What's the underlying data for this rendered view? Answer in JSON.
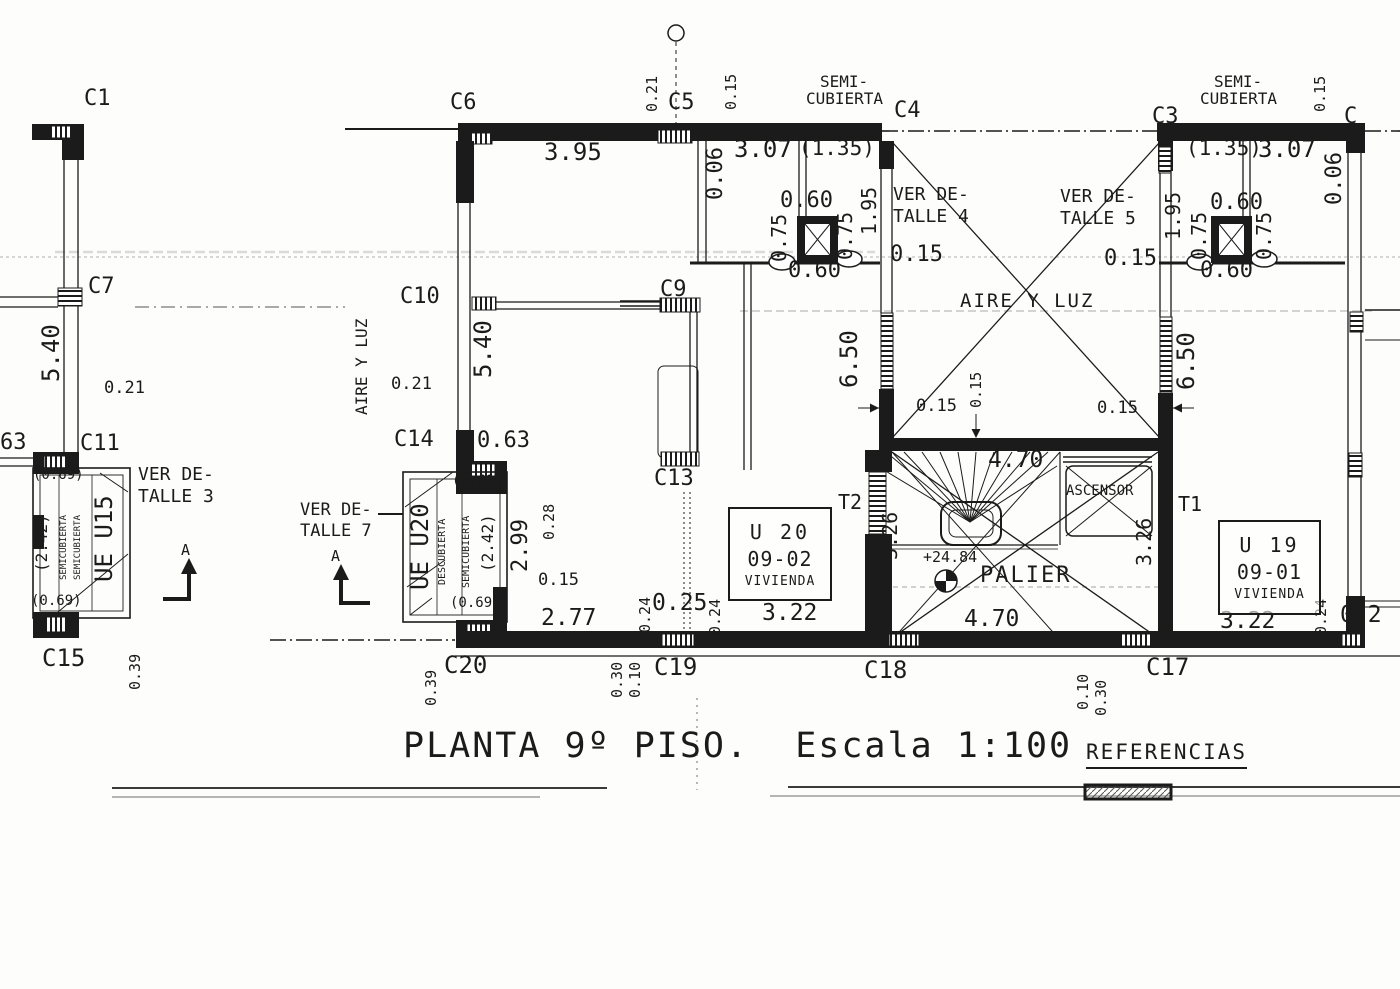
{
  "document": {
    "title": "PLANTA 9º PISO.  Escala 1:100",
    "references_heading": "REFERENCIAS"
  },
  "plan": {
    "floor": "9º PISO",
    "scale": "1:100",
    "level_mark": "+24.84",
    "units": {
      "u20": {
        "line1": "U 20",
        "line2": "09-02",
        "line3": "VIVIENDA"
      },
      "u19": {
        "line1": "U 19",
        "line2": "09-01",
        "line3": "VIVIENDA"
      }
    },
    "labels": [
      {
        "t": "C1",
        "x": 84,
        "y": 88,
        "s": 22,
        "k": "column-label"
      },
      {
        "t": "C6",
        "x": 450,
        "y": 92,
        "s": 22,
        "k": "column-label"
      },
      {
        "t": "C5",
        "x": 668,
        "y": 92,
        "s": 22,
        "k": "column-label"
      },
      {
        "t": "C4",
        "x": 894,
        "y": 100,
        "s": 22,
        "k": "column-label"
      },
      {
        "t": "C3",
        "x": 1152,
        "y": 106,
        "s": 22,
        "k": "column-label"
      },
      {
        "t": "C",
        "x": 1344,
        "y": 106,
        "s": 22,
        "k": "column-label"
      },
      {
        "t": "C7",
        "x": 88,
        "y": 276,
        "s": 22,
        "k": "column-label"
      },
      {
        "t": "C10",
        "x": 400,
        "y": 286,
        "s": 22,
        "k": "column-label"
      },
      {
        "t": "C9",
        "x": 660,
        "y": 279,
        "s": 22,
        "k": "column-label"
      },
      {
        "t": "C11",
        "x": 80,
        "y": 433,
        "s": 22,
        "k": "column-label"
      },
      {
        "t": "C14",
        "x": 394,
        "y": 429,
        "s": 22,
        "k": "column-label"
      },
      {
        "t": "C13",
        "x": 654,
        "y": 468,
        "s": 22,
        "k": "column-label"
      },
      {
        "t": "T2",
        "x": 838,
        "y": 492,
        "s": 20,
        "k": "column-label"
      },
      {
        "t": "T1",
        "x": 1178,
        "y": 494,
        "s": 20,
        "k": "column-label"
      },
      {
        "t": "C15",
        "x": 42,
        "y": 646,
        "s": 24,
        "k": "column-label"
      },
      {
        "t": "C20",
        "x": 444,
        "y": 653,
        "s": 24,
        "k": "column-label"
      },
      {
        "t": "C19",
        "x": 654,
        "y": 655,
        "s": 24,
        "k": "column-label"
      },
      {
        "t": "C18",
        "x": 864,
        "y": 658,
        "s": 24,
        "k": "column-label"
      },
      {
        "t": "C17",
        "x": 1146,
        "y": 655,
        "s": 24,
        "k": "column-label"
      },
      {
        "t": "63",
        "x": 0,
        "y": 432,
        "s": 22,
        "k": "column-label"
      },
      {
        "t": "3.95",
        "x": 544,
        "y": 140,
        "s": 24,
        "k": "dimension-label"
      },
      {
        "t": "3.07",
        "x": 734,
        "y": 137,
        "s": 24,
        "k": "dimension-label"
      },
      {
        "t": "(1.35)",
        "x": 799,
        "y": 138,
        "s": 21,
        "k": "dimension-label"
      },
      {
        "t": "(1.35)",
        "x": 1186,
        "y": 138,
        "s": 21,
        "k": "dimension-label"
      },
      {
        "t": "3.07",
        "x": 1258,
        "y": 137,
        "s": 24,
        "k": "dimension-label"
      },
      {
        "t": "0.60",
        "x": 780,
        "y": 190,
        "s": 22,
        "k": "dimension-label"
      },
      {
        "t": "0.60",
        "x": 788,
        "y": 260,
        "s": 22,
        "k": "dimension-label"
      },
      {
        "t": "0.60",
        "x": 1210,
        "y": 192,
        "s": 22,
        "k": "dimension-label"
      },
      {
        "t": "0.60",
        "x": 1200,
        "y": 260,
        "s": 22,
        "k": "dimension-label"
      },
      {
        "t": "0.15",
        "x": 890,
        "y": 244,
        "s": 22,
        "k": "dimension-label"
      },
      {
        "t": "0.15",
        "x": 1104,
        "y": 248,
        "s": 22,
        "k": "dimension-label"
      },
      {
        "t": "0.21",
        "x": 104,
        "y": 380,
        "s": 17,
        "k": "dimension-label"
      },
      {
        "t": "0.21",
        "x": 391,
        "y": 376,
        "s": 17,
        "k": "dimension-label"
      },
      {
        "t": "0.63",
        "x": 477,
        "y": 430,
        "s": 22,
        "k": "dimension-label"
      },
      {
        "t": "0.15",
        "x": 916,
        "y": 398,
        "s": 17,
        "k": "dimension-label"
      },
      {
        "t": "0.15",
        "x": 1097,
        "y": 400,
        "s": 17,
        "k": "dimension-label"
      },
      {
        "t": "0.15",
        "x": 538,
        "y": 572,
        "s": 17,
        "k": "dimension-label"
      },
      {
        "t": "0.25",
        "x": 652,
        "y": 592,
        "s": 23,
        "k": "dimension-label"
      },
      {
        "t": "2.77",
        "x": 541,
        "y": 607,
        "s": 23,
        "k": "dimension-label"
      },
      {
        "t": "3.22",
        "x": 762,
        "y": 602,
        "s": 23,
        "k": "dimension-label"
      },
      {
        "t": "3.22",
        "x": 1220,
        "y": 610,
        "s": 23,
        "k": "dimension-label"
      },
      {
        "t": "4.70",
        "x": 988,
        "y": 449,
        "s": 23,
        "k": "dimension-label"
      },
      {
        "t": "4.70",
        "x": 964,
        "y": 608,
        "s": 23,
        "k": "dimension-label"
      },
      {
        "t": "0.2",
        "x": 1340,
        "y": 604,
        "s": 23,
        "k": "dimension-label"
      },
      {
        "t": "+24.84",
        "x": 923,
        "y": 550,
        "s": 15,
        "k": "level-label"
      },
      {
        "t": "(0.69)",
        "x": 33,
        "y": 468,
        "s": 14,
        "k": "dimension-label"
      },
      {
        "t": "(0.69)",
        "x": 31,
        "y": 594,
        "s": 14,
        "k": "dimension-label"
      },
      {
        "t": "(0.69)",
        "x": 452,
        "y": 474,
        "s": 14,
        "k": "dimension-label"
      },
      {
        "t": "(0.69)",
        "x": 450,
        "y": 596,
        "s": 14,
        "k": "dimension-label"
      },
      {
        "t": "SEMI-",
        "x": 820,
        "y": 74,
        "s": 16,
        "k": "room-label"
      },
      {
        "t": "CUBIERTA",
        "x": 806,
        "y": 91,
        "s": 16,
        "k": "room-label"
      },
      {
        "t": "SEMI-",
        "x": 1214,
        "y": 74,
        "s": 16,
        "k": "room-label"
      },
      {
        "t": "CUBIERTA",
        "x": 1200,
        "y": 91,
        "s": 16,
        "k": "room-label"
      },
      {
        "t": "AIRE Y LUZ",
        "x": 960,
        "y": 292,
        "s": 19,
        "ls": 2,
        "k": "room-label"
      },
      {
        "t": "PALIER",
        "x": 980,
        "y": 565,
        "s": 22,
        "ls": 2,
        "k": "room-label"
      },
      {
        "t": "ASCENSOR",
        "x": 1066,
        "y": 484,
        "s": 14,
        "k": "room-label"
      },
      {
        "t": "VER DE-",
        "x": 893,
        "y": 186,
        "s": 18,
        "k": "note-label"
      },
      {
        "t": "TALLE 4",
        "x": 893,
        "y": 208,
        "s": 18,
        "k": "note-label"
      },
      {
        "t": "VER DE-",
        "x": 1060,
        "y": 188,
        "s": 18,
        "k": "note-label"
      },
      {
        "t": "TALLE 5",
        "x": 1060,
        "y": 210,
        "s": 18,
        "k": "note-label"
      },
      {
        "t": "VER DE-",
        "x": 138,
        "y": 466,
        "s": 18,
        "k": "note-label"
      },
      {
        "t": "TALLE 3",
        "x": 138,
        "y": 488,
        "s": 18,
        "k": "note-label"
      },
      {
        "t": "VER DE-",
        "x": 300,
        "y": 502,
        "s": 17,
        "k": "note-label"
      },
      {
        "t": "TALLE 7",
        "x": 300,
        "y": 523,
        "s": 17,
        "k": "note-label"
      },
      {
        "t": "A",
        "x": 181,
        "y": 543,
        "s": 15,
        "k": "section-label"
      },
      {
        "t": "A",
        "x": 331,
        "y": 549,
        "s": 15,
        "k": "section-label"
      },
      {
        "t": "0.21",
        "x": 645,
        "y": 112,
        "s": 15,
        "r": -90,
        "k": "dimension-label"
      },
      {
        "t": "0.15",
        "x": 724,
        "y": 110,
        "s": 15,
        "r": -90,
        "k": "dimension-label"
      },
      {
        "t": "0.06",
        "x": 705,
        "y": 200,
        "s": 22,
        "r": -90,
        "k": "dimension-label"
      },
      {
        "t": "0.75",
        "x": 769,
        "y": 262,
        "s": 20,
        "r": -90,
        "k": "dimension-label"
      },
      {
        "t": "0.75",
        "x": 835,
        "y": 260,
        "s": 20,
        "r": -90,
        "k": "dimension-label"
      },
      {
        "t": "1.95",
        "x": 859,
        "y": 235,
        "s": 20,
        "r": -90,
        "k": "dimension-label"
      },
      {
        "t": "1.95",
        "x": 1163,
        "y": 240,
        "s": 20,
        "r": -90,
        "k": "dimension-label"
      },
      {
        "t": "0.15",
        "x": 1313,
        "y": 112,
        "s": 15,
        "r": -90,
        "k": "dimension-label"
      },
      {
        "t": "0.06",
        "x": 1324,
        "y": 205,
        "s": 22,
        "r": -90,
        "k": "dimension-label"
      },
      {
        "t": "0.75",
        "x": 1189,
        "y": 260,
        "s": 20,
        "r": -90,
        "k": "dimension-label"
      },
      {
        "t": "0.75",
        "x": 1254,
        "y": 260,
        "s": 20,
        "r": -90,
        "k": "dimension-label"
      },
      {
        "t": "5.40",
        "x": 39,
        "y": 382,
        "s": 24,
        "r": -90,
        "k": "dimension-label"
      },
      {
        "t": "5.40",
        "x": 471,
        "y": 378,
        "s": 24,
        "r": -90,
        "k": "dimension-label"
      },
      {
        "t": "6.50",
        "x": 837,
        "y": 388,
        "s": 24,
        "r": -90,
        "k": "dimension-label"
      },
      {
        "t": "6.50",
        "x": 1174,
        "y": 390,
        "s": 24,
        "r": -90,
        "k": "dimension-label"
      },
      {
        "t": "0.15",
        "x": 969,
        "y": 408,
        "s": 15,
        "r": -90,
        "k": "dimension-label"
      },
      {
        "t": "(2.42)",
        "x": 34,
        "y": 572,
        "s": 16,
        "r": -90,
        "k": "dimension-label"
      },
      {
        "t": "(2.42)",
        "x": 480,
        "y": 572,
        "s": 16,
        "r": -90,
        "k": "dimension-label"
      },
      {
        "t": "SEMICUBIERTA",
        "x": 60,
        "y": 580,
        "s": 9,
        "r": -90,
        "k": "room-label"
      },
      {
        "t": "SEMICUBIERTA",
        "x": 74,
        "y": 580,
        "s": 9,
        "r": -90,
        "k": "room-label"
      },
      {
        "t": "UE U15",
        "x": 92,
        "y": 582,
        "s": 24,
        "r": -90,
        "k": "room-label"
      },
      {
        "t": "UE U20",
        "x": 408,
        "y": 590,
        "s": 24,
        "r": -90,
        "k": "room-label"
      },
      {
        "t": "DESCUBIERTA",
        "x": 438,
        "y": 585,
        "s": 10,
        "r": -90,
        "k": "room-label"
      },
      {
        "t": "SEMICUBIERTA",
        "x": 462,
        "y": 588,
        "s": 10,
        "r": -90,
        "k": "room-label"
      },
      {
        "t": "2.99",
        "x": 510,
        "y": 572,
        "s": 22,
        "r": -90,
        "k": "dimension-label"
      },
      {
        "t": "0.28",
        "x": 542,
        "y": 540,
        "s": 15,
        "r": -90,
        "k": "dimension-label"
      },
      {
        "t": "AIRE Y LUZ",
        "x": 354,
        "y": 415,
        "s": 16,
        "r": -90,
        "k": "room-label"
      },
      {
        "t": "0.24",
        "x": 638,
        "y": 633,
        "s": 15,
        "r": -90,
        "k": "dimension-label"
      },
      {
        "t": "0.24",
        "x": 708,
        "y": 635,
        "s": 15,
        "r": -90,
        "k": "dimension-label"
      },
      {
        "t": "0.24",
        "x": 1314,
        "y": 635,
        "s": 15,
        "r": -90,
        "k": "dimension-label"
      },
      {
        "t": "0.39",
        "x": 128,
        "y": 690,
        "s": 15,
        "r": -90,
        "k": "dimension-label"
      },
      {
        "t": "0.39",
        "x": 424,
        "y": 706,
        "s": 15,
        "r": -90,
        "k": "dimension-label"
      },
      {
        "t": "0.30",
        "x": 610,
        "y": 698,
        "s": 15,
        "r": -90,
        "k": "dimension-label"
      },
      {
        "t": "0.10",
        "x": 628,
        "y": 698,
        "s": 15,
        "r": -90,
        "k": "dimension-label"
      },
      {
        "t": "0.10",
        "x": 1076,
        "y": 710,
        "s": 15,
        "r": -90,
        "k": "dimension-label"
      },
      {
        "t": "0.30",
        "x": 1094,
        "y": 716,
        "s": 15,
        "r": -90,
        "k": "dimension-label"
      },
      {
        "t": "3.26",
        "x": 880,
        "y": 560,
        "s": 20,
        "r": -90,
        "k": "dimension-label"
      },
      {
        "t": "3.26",
        "x": 1134,
        "y": 566,
        "s": 20,
        "r": -90,
        "k": "dimension-label"
      }
    ]
  }
}
